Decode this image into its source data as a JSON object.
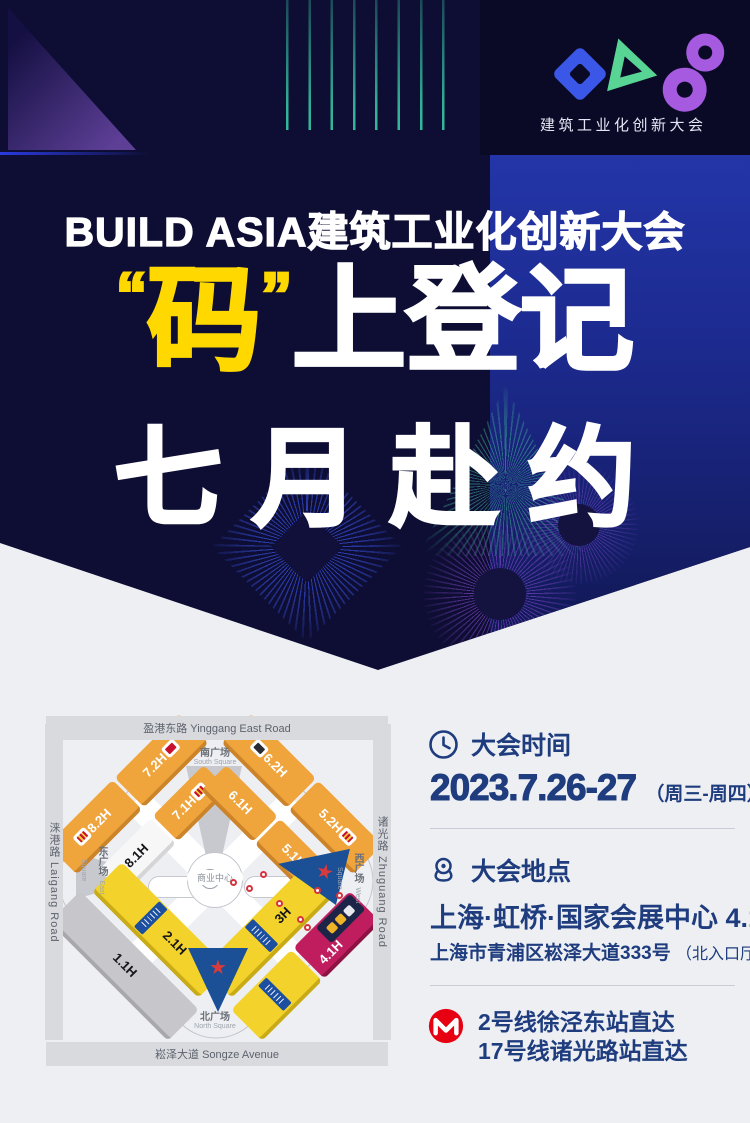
{
  "colors": {
    "accent_yellow": "#ffd800",
    "deep_navy": "#0e0e34",
    "bright_blue": "#1c2a8e",
    "text_navy": "#1e3c7e",
    "metro_red": "#e60012",
    "hall_orange": "#f0a43c",
    "hall_yellow": "#f3d32b",
    "hall_highlight_crimson": "#c01d5e",
    "entrance_blue": "#1b4f96"
  },
  "header": {
    "logo_text": "建筑工业化创新大会"
  },
  "hero": {
    "title": "BUILD ASIA建筑工业化创新大会",
    "quote_open": "“",
    "highlight": "码",
    "quote_close": "”",
    "slogan_rest": "上登记",
    "slogan_line2": "七月赴约"
  },
  "map": {
    "roads": {
      "top": "盈港东路 Yinggang East Road",
      "bottom": "崧泽大道 Songze Avenue",
      "left": "涞港路 Laigang Road",
      "right": "诸光路 Zhuguang Road"
    },
    "squares": {
      "south_cn": "南广场",
      "south_en": "South Square",
      "north_cn": "北广场",
      "north_en": "North Square",
      "east_cn": "东广场",
      "east_en": "East Square",
      "west_cn": "西广场",
      "west_en": "West Square"
    },
    "center_label": "商业中心",
    "center_icon_glyph": "ℹ",
    "halls": {
      "h82": "8.2H",
      "h72": "7.2H",
      "h81": "8.1H",
      "h71": "7.1H",
      "h62": "6.2H",
      "h52": "5.2H",
      "h61": "6.1H",
      "h51": "5.1H",
      "h11": "1.1H",
      "h21": "2.1H",
      "h30": "3H",
      "h41": "4.1H"
    }
  },
  "details": {
    "time": {
      "heading": "大会时间",
      "date": "2023.7.26-27",
      "weekdays": "（周三-周四）"
    },
    "location": {
      "heading": "大会地点",
      "venue": "上海·虹桥·国家会展中心 4.1H",
      "address": "上海市青浦区崧泽大道333号",
      "address_note": "（北入口厅）"
    },
    "metro": {
      "line1": "2号线徐泾东站直达",
      "line2": "17号线诸光路站直达"
    }
  }
}
